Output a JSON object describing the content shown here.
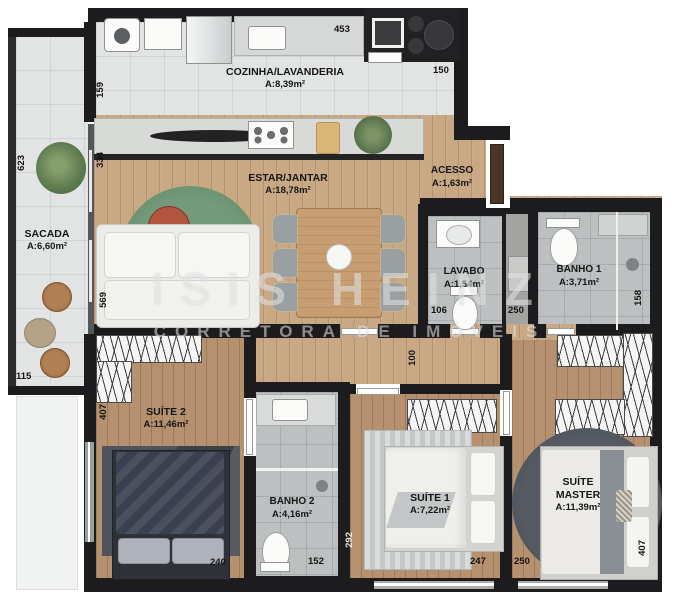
{
  "watermark": {
    "brand": "ISIS HEINZ",
    "tagline": "CORRETORA DE IMÓVEIS"
  },
  "rooms": {
    "cozinha": {
      "name": "COZINHA/LAVANDERIA",
      "area": "A:8,39m²"
    },
    "estar": {
      "name": "ESTAR/JANTAR",
      "area": "A:18,78m²"
    },
    "acesso": {
      "name": "ACESSO",
      "area": "A:1,63m²"
    },
    "sacada": {
      "name": "SACADA",
      "area": "A:6,60m²"
    },
    "lavabo": {
      "name": "LAVABO",
      "area": "A:1,54m²"
    },
    "banho1": {
      "name": "BANHO 1",
      "area": "A:3,71m²"
    },
    "suite2": {
      "name": "SUÍTE 2",
      "area": "A:11,46m²"
    },
    "banho2": {
      "name": "BANHO 2",
      "area": "A:4,16m²"
    },
    "suite1": {
      "name": "SUÍTE 1",
      "area": "A:7,22m²"
    },
    "suiteMaster": {
      "name": "SUÍTE MASTER",
      "area": "A:11,39m²"
    }
  },
  "dimensions": {
    "kitchen_top": "453",
    "kitchen_right": "150",
    "kitchen_left": "159",
    "sacada_height": "623",
    "sacada_width": "115",
    "estar_left_upper": "334",
    "estar_left_lower": "569",
    "suite2_height": "407",
    "suite2_width": "240",
    "banho2_width": "152",
    "banho2_height": "292",
    "suite1_width": "247",
    "master_width": "250",
    "master_height": "407",
    "lavabo_width": "106",
    "shaft_width": "250",
    "banho1_height": "158",
    "hall_width": "100"
  },
  "colors": {
    "wall": "#1c1c1e",
    "wood": "#c9a884",
    "wood_dark": "#b6916f",
    "tile": "#e2e4e3",
    "bath_tile": "#bcc0c1",
    "rug_green": "#6b9373",
    "table_red": "#b2553e",
    "dark_rug": "#4d525a"
  }
}
